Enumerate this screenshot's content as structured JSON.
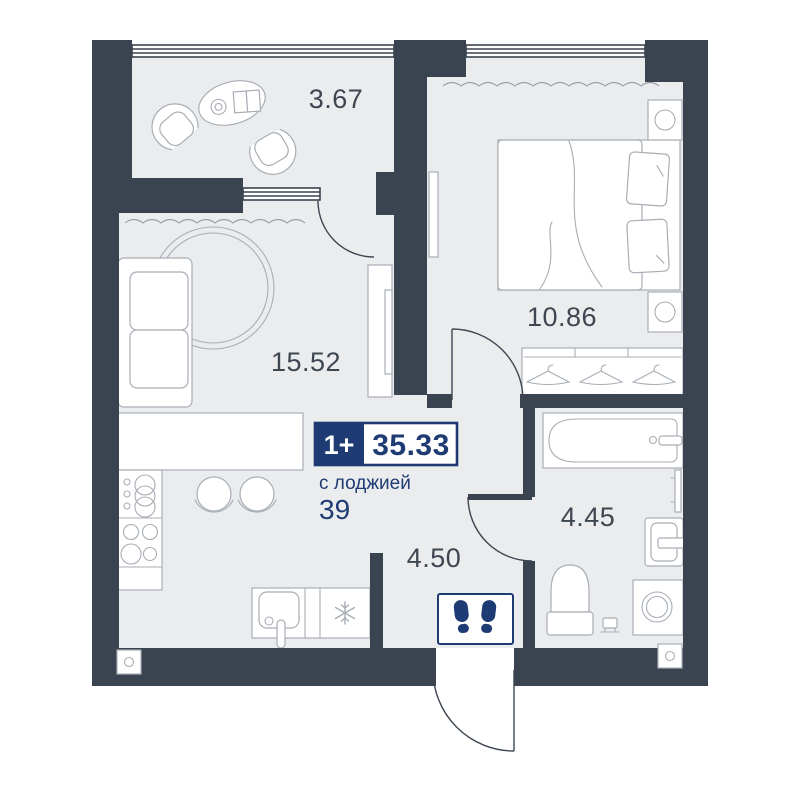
{
  "unit_card": {
    "type_label": "1+",
    "area_value": "35.33",
    "area_note": "с лоджией",
    "unit_number": "39"
  },
  "rooms": {
    "loggia": {
      "name": "лоджия",
      "area": "3.67"
    },
    "living_kitchen": {
      "name": "кухня-гостиная",
      "area": "15.52"
    },
    "bedroom": {
      "name": "спальня",
      "area": "10.86"
    },
    "hallway": {
      "name": "прихожая",
      "area": "4.50"
    },
    "bathroom": {
      "name": "санузел",
      "area": "4.45"
    }
  },
  "icons": {
    "entrance_mat": "footprints-icon",
    "fridge": "snowflake-icon"
  },
  "colors": {
    "wall": "#3a4450",
    "floor": "#ebecee",
    "furniture_stroke": "#a8aeb5",
    "line": "#3e4651",
    "accent_navy": "#1f3b73",
    "curtain": "#9aa1a9",
    "background": "#ffffff"
  }
}
